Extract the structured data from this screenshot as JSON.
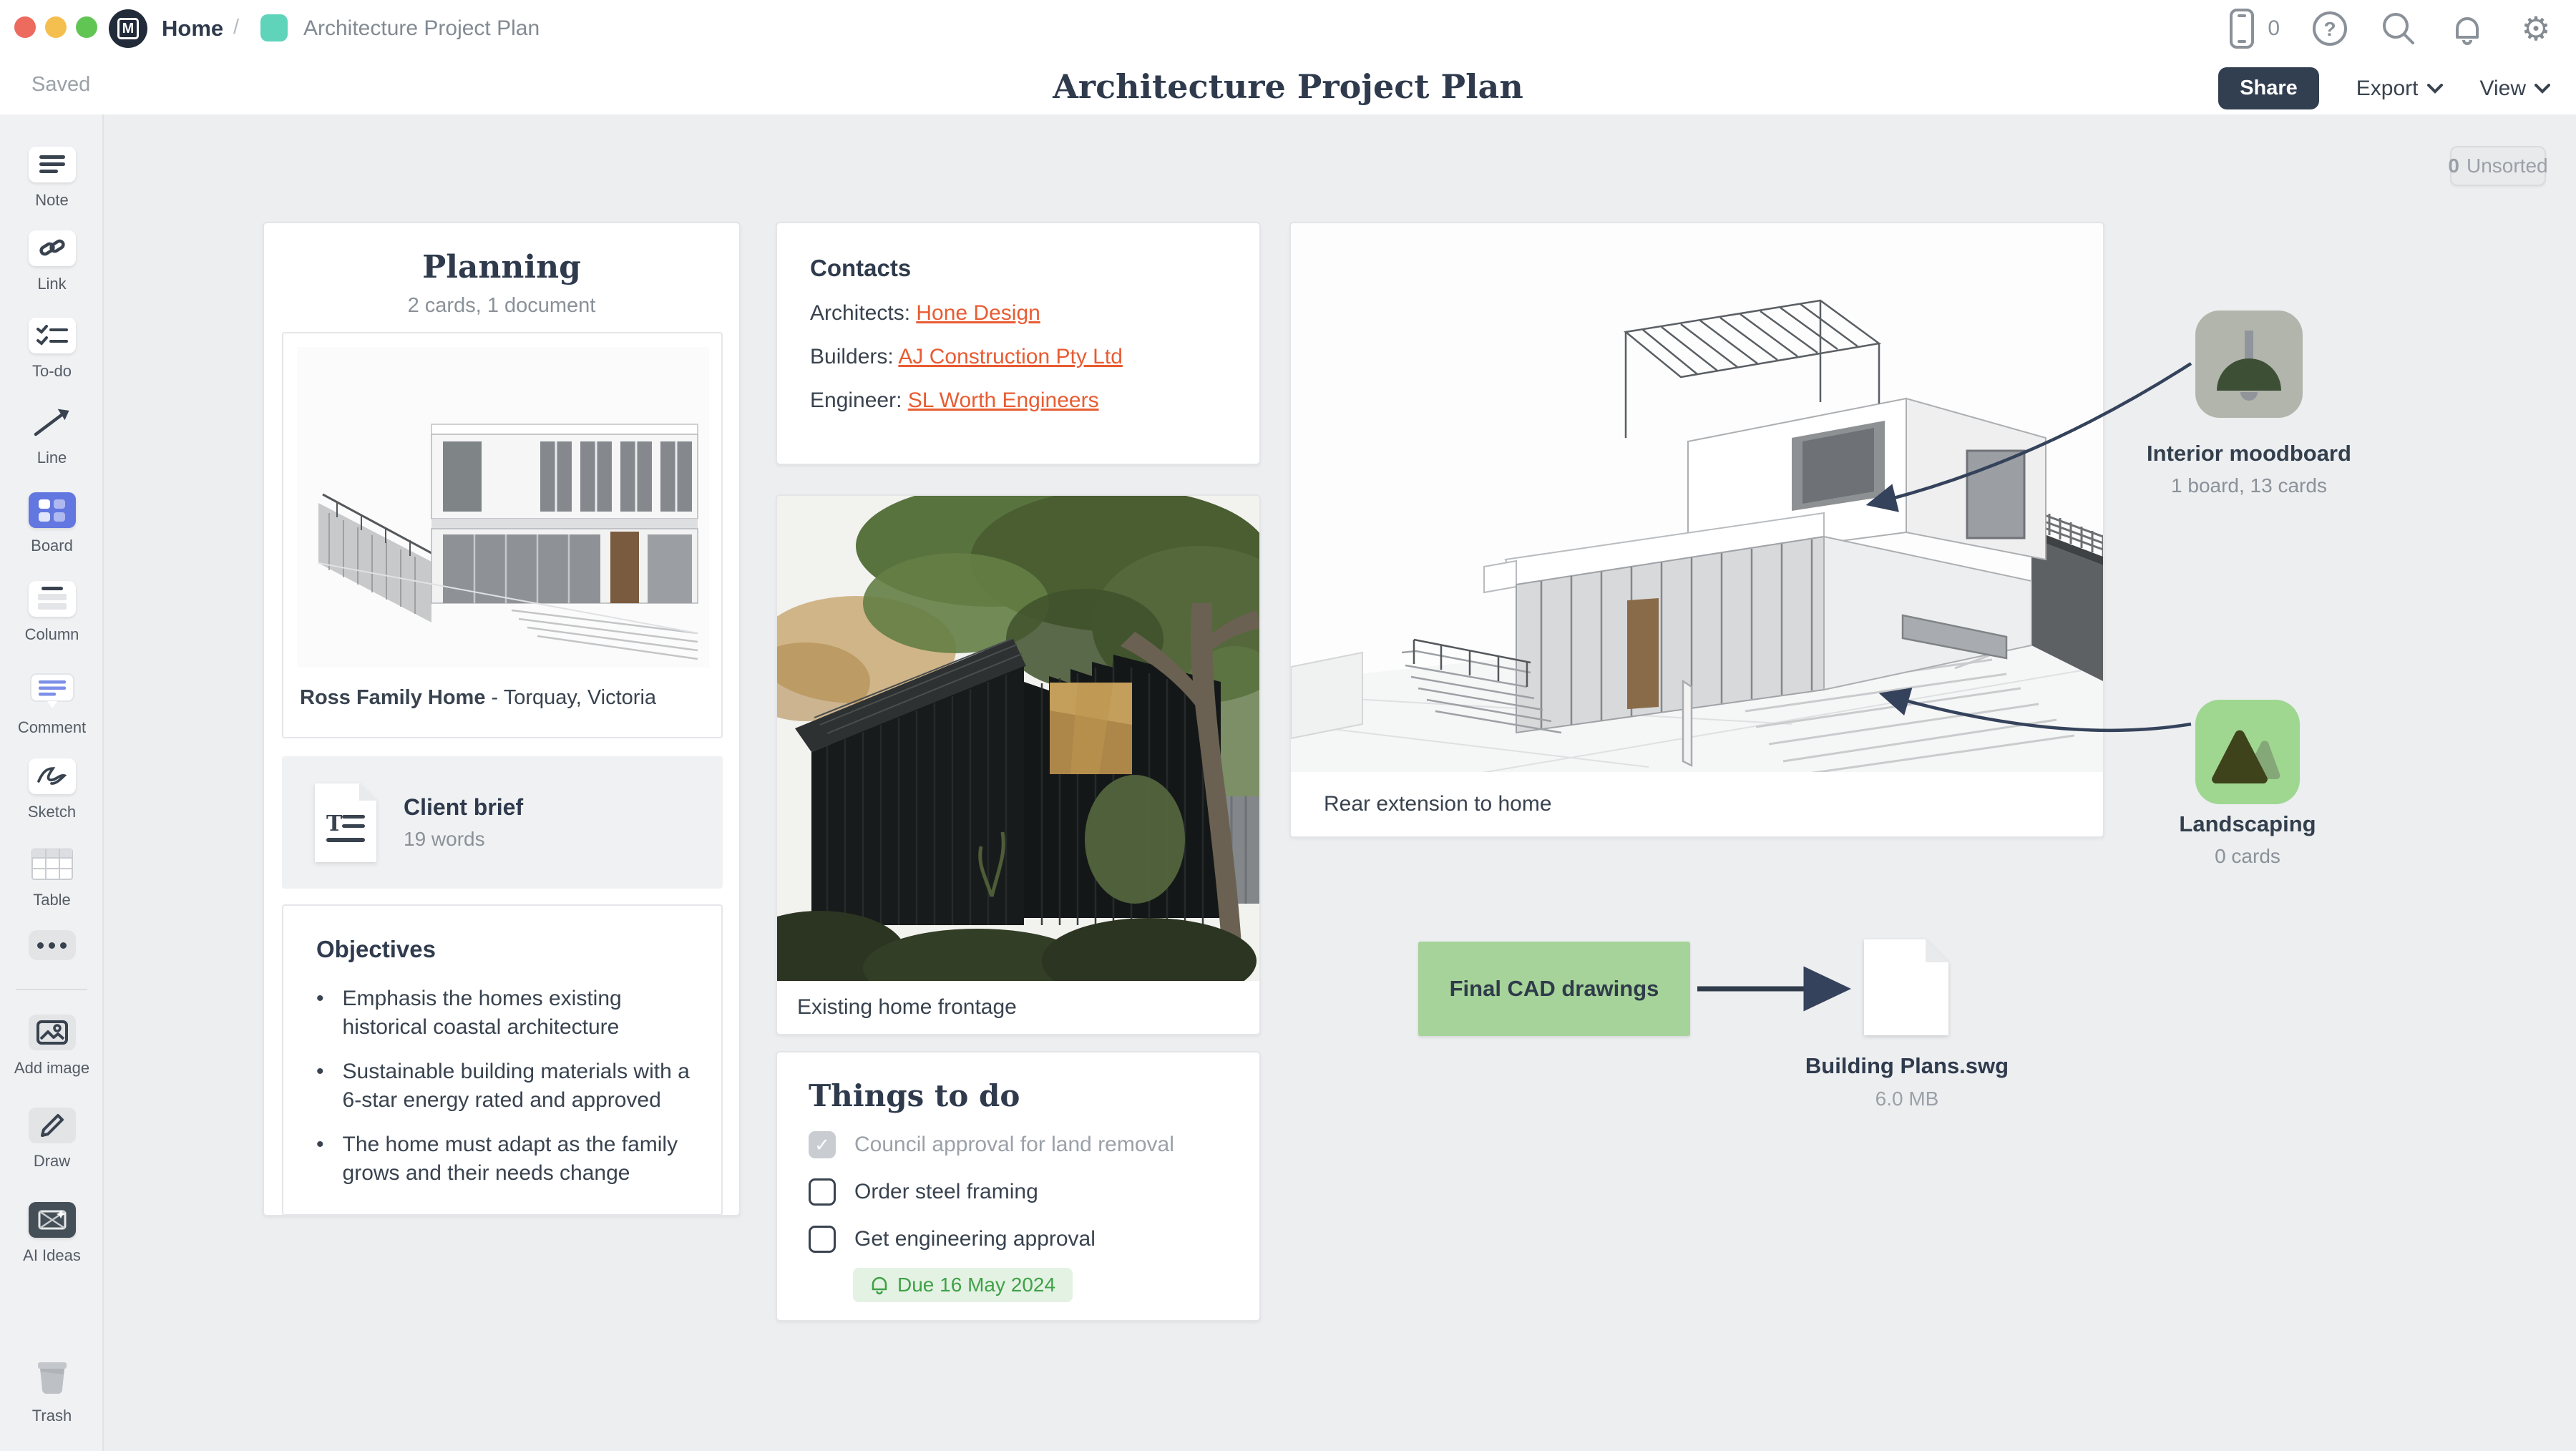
{
  "window": {
    "breadcrumb": {
      "home": "Home",
      "separator": "/",
      "board": "Architecture Project Plan"
    },
    "device_count": "0"
  },
  "header": {
    "saved": "Saved",
    "title": "Architecture Project Plan",
    "share": "Share",
    "export": "Export",
    "view": "View"
  },
  "sidebar": {
    "items": [
      {
        "label": "Note"
      },
      {
        "label": "Link"
      },
      {
        "label": "To-do"
      },
      {
        "label": "Line"
      },
      {
        "label": "Board"
      },
      {
        "label": "Column"
      },
      {
        "label": "Comment"
      },
      {
        "label": "Sketch"
      },
      {
        "label": "Table"
      },
      {
        "label": "Add image"
      },
      {
        "label": "Draw"
      },
      {
        "label": "AI Ideas"
      },
      {
        "label": "Trash"
      }
    ]
  },
  "canvas": {
    "unsorted": {
      "count": "0",
      "label": "Unsorted"
    },
    "planning": {
      "title": "Planning",
      "meta": "2 cards, 1 document",
      "image_caption_bold": "Ross Family Home",
      "image_caption_rest": " - Torquay, Victoria",
      "doc": {
        "title": "Client brief",
        "meta": "19 words"
      },
      "objectives": {
        "title": "Objectives",
        "bullet": "•",
        "bullets": [
          "Emphasis the homes existing historical coastal architecture",
          "Sustainable building materials with a 6-star energy rated and approved",
          "The home must adapt as the family grows and their needs change"
        ]
      }
    },
    "contacts": {
      "title": "Contacts",
      "rows": [
        {
          "label": "Architects: ",
          "link": "Hone Design"
        },
        {
          "label": "Builders: ",
          "link": "AJ Construction Pty Ltd"
        },
        {
          "label": "Engineer: ",
          "link": "SL Worth Engineers"
        }
      ]
    },
    "frontage": {
      "caption": "Existing home frontage"
    },
    "todo": {
      "title": "Things to do",
      "check": "✓",
      "items": [
        {
          "text": "Council approval for land removal",
          "checked": true
        },
        {
          "text": "Order steel framing",
          "checked": false
        },
        {
          "text": "Get engineering approval",
          "checked": false
        }
      ],
      "due": "Due 16 May 2024"
    },
    "rear": {
      "caption": "Rear extension to home"
    },
    "moodboard": {
      "title": "Interior moodboard",
      "meta": "1 board, 13 cards"
    },
    "landscaping": {
      "title": "Landscaping",
      "meta": "0 cards"
    },
    "cad": {
      "label": "Final CAD drawings"
    },
    "file": {
      "name": "Building Plans.swg",
      "size": "6.0 MB"
    }
  },
  "colors": {
    "link_accent": "#E85C33",
    "note_green": "#A6D399",
    "board_blue": "#6377E1",
    "breadcrumb_teal": "#5FD4BA",
    "due_green_text": "#3FA147",
    "due_green_bg": "#E4F2E3",
    "dark_navy": "#2F3B4D",
    "canvas_gray": "#ECEEF0"
  }
}
